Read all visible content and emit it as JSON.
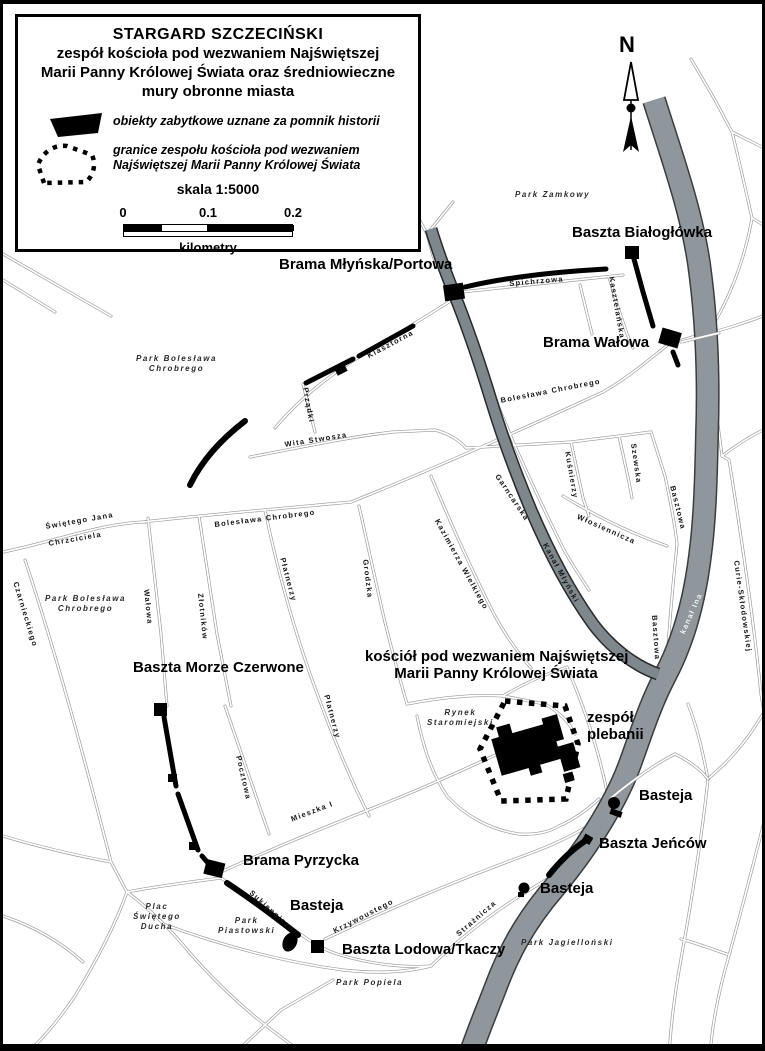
{
  "title_box": {
    "line1": "STARGARD SZCZECIŃSKI",
    "line2": "zespół kościoła pod wezwaniem Najświętszej",
    "line3": "Marii Panny Królowej Świata oraz średniowieczne",
    "line4": "mury obronne miasta",
    "legend_item1": "obiekty zabytkowe uznane za pomnik historii",
    "legend_item2_line1": "granice zespołu kościoła pod wezwaniem",
    "legend_item2_line2": "Najświętszej Marii Panny Królowej Świata",
    "scale_label": "skala 1:5000",
    "scale_ticks": [
      "0",
      "0.1",
      "0.2"
    ],
    "scale_unit": "kilometry"
  },
  "compass": {
    "label": "N"
  },
  "water": {
    "river_label": "kanał Ina",
    "canal_label": "Kanał Młyński",
    "river_color": "#8f979c",
    "canal_color": "#7e878c"
  },
  "monument_labels": [
    {
      "id": "baszta-bialoglowka",
      "lines": [
        "Baszta Białogłówka"
      ],
      "x": 569,
      "y": 220
    },
    {
      "id": "brama-mlynska-portowa",
      "lines": [
        "Brama Młyńska/Portowa"
      ],
      "x": 276,
      "y": 252
    },
    {
      "id": "brama-walowa",
      "lines": [
        "Brama Wałowa"
      ],
      "x": 540,
      "y": 330
    },
    {
      "id": "baszta-morze-czerwone",
      "lines": [
        "Baszta Morze Czerwone"
      ],
      "x": 130,
      "y": 655
    },
    {
      "id": "kosciol-mariacki",
      "lines": [
        "kościół pod wezwaniem Najświętszej",
        "Marii Panny Królowej Świata"
      ],
      "x": 362,
      "y": 644,
      "w": 262,
      "align": "center"
    },
    {
      "id": "zespol-plebanii",
      "lines": [
        "zespół",
        "plebanii"
      ],
      "x": 584,
      "y": 705
    },
    {
      "id": "basteja-polnocna",
      "lines": [
        "Basteja"
      ],
      "x": 636,
      "y": 783
    },
    {
      "id": "baszta-jencow",
      "lines": [
        "Baszta Jeńców"
      ],
      "x": 596,
      "y": 831
    },
    {
      "id": "basteja-wschodnia",
      "lines": [
        "Basteja"
      ],
      "x": 537,
      "y": 876
    },
    {
      "id": "brama-pyrzycka",
      "lines": [
        "Brama Pyrzycka"
      ],
      "x": 240,
      "y": 848
    },
    {
      "id": "basteja-poludniowa",
      "lines": [
        "Basteja"
      ],
      "x": 287,
      "y": 893
    },
    {
      "id": "baszta-lodowa-tkaczy",
      "lines": [
        "Baszta Lodowa/Tkaczy"
      ],
      "x": 339,
      "y": 937
    }
  ],
  "park_labels": [
    {
      "id": "park-zamkowy",
      "lines": [
        "Park Zamkowy"
      ],
      "x": 512,
      "y": 186
    },
    {
      "id": "park-boleslawa-chrobrego-1",
      "lines": [
        "Park Bolesława",
        "Chrobrego"
      ],
      "x": 133,
      "y": 350
    },
    {
      "id": "park-boleslawa-chrobrego-2",
      "lines": [
        "Park Bolesława",
        "Chrobrego"
      ],
      "x": 42,
      "y": 590
    },
    {
      "id": "rynek-staromiejski",
      "lines": [
        "Rynek",
        "Staromiejski"
      ],
      "x": 424,
      "y": 704
    },
    {
      "id": "plac-swietego-ducha",
      "lines": [
        "Plac",
        "Świętego",
        "Ducha"
      ],
      "x": 130,
      "y": 898
    },
    {
      "id": "park-piastowski",
      "lines": [
        "Park",
        "Piastowski"
      ],
      "x": 215,
      "y": 912
    },
    {
      "id": "park-popiela",
      "lines": [
        "Park Popiela"
      ],
      "x": 333,
      "y": 974
    },
    {
      "id": "park-jagiellonski",
      "lines": [
        "Park Jagielloński"
      ],
      "x": 518,
      "y": 934
    }
  ],
  "street_labels": [
    {
      "id": "spichrzowa",
      "text": "Spichrzowa",
      "x": 506,
      "y": 276,
      "rot": -5
    },
    {
      "id": "kasztelanska",
      "text": "Kasztelańska",
      "x": 612,
      "y": 272,
      "rot": 80
    },
    {
      "id": "klasztorna",
      "text": "Klasztorna",
      "x": 363,
      "y": 349,
      "rot": -28
    },
    {
      "id": "przadki",
      "text": "Prządki",
      "x": 306,
      "y": 383,
      "rot": 80
    },
    {
      "id": "wita-stwosza",
      "text": "Wita Stwosza",
      "x": 281,
      "y": 437,
      "rot": -9
    },
    {
      "id": "boleslawa-chrobrego-n",
      "text": "Bolesława Chrobrego",
      "x": 497,
      "y": 393,
      "rot": -11
    },
    {
      "id": "boleslawa-chrobrego-s",
      "text": "Bolesława Chrobrego",
      "x": 211,
      "y": 517,
      "rot": -7
    },
    {
      "id": "swietego-jana",
      "text": "Świętego Jana",
      "x": 42,
      "y": 519,
      "rot": -10
    },
    {
      "id": "chrzciciela",
      "text": "Chrzciciela",
      "x": 45,
      "y": 536,
      "rot": -10
    },
    {
      "id": "czarnieckiego",
      "text": "Czarnieckiego",
      "x": 16,
      "y": 577,
      "rot": 73
    },
    {
      "id": "walowa",
      "text": "Wałowa",
      "x": 147,
      "y": 585,
      "rot": 84
    },
    {
      "id": "zlotnikow",
      "text": "Złotników",
      "x": 201,
      "y": 589,
      "rot": 84
    },
    {
      "id": "platnerzy-n",
      "text": "Płatnerzy",
      "x": 283,
      "y": 553,
      "rot": 75
    },
    {
      "id": "platnerzy-s",
      "text": "Płatnerzy",
      "x": 327,
      "y": 690,
      "rot": 75
    },
    {
      "id": "grodzka",
      "text": "Grodzka",
      "x": 366,
      "y": 555,
      "rot": 83
    },
    {
      "id": "kazimierza-wielkiego",
      "text": "Kazimierza Wielkiego",
      "x": 437,
      "y": 514,
      "rot": 61
    },
    {
      "id": "garncarska",
      "text": "Garncarska",
      "x": 497,
      "y": 469,
      "rot": 56
    },
    {
      "id": "kusnierzy",
      "text": "Kuśnierzy",
      "x": 568,
      "y": 447,
      "rot": 80
    },
    {
      "id": "szewska",
      "text": "Szewska",
      "x": 634,
      "y": 439,
      "rot": 82
    },
    {
      "id": "basztowa-n",
      "text": "Basztowa",
      "x": 673,
      "y": 481,
      "rot": 76
    },
    {
      "id": "basztowa-s",
      "text": "Basztowa",
      "x": 655,
      "y": 611,
      "rot": 86
    },
    {
      "id": "wlosiennicza",
      "text": "Włosiennicza",
      "x": 576,
      "y": 509,
      "rot": 24
    },
    {
      "id": "curie-sklodowskiej",
      "text": "Curie-Skłodowskiej",
      "x": 737,
      "y": 556,
      "rot": 82
    },
    {
      "id": "pocztowa",
      "text": "Pocztowa",
      "x": 239,
      "y": 751,
      "rot": 77
    },
    {
      "id": "mieszka-i",
      "text": "Mieszka I",
      "x": 287,
      "y": 812,
      "rot": -21
    },
    {
      "id": "sukiennicza",
      "text": "Sukiennicza",
      "x": 250,
      "y": 885,
      "rot": 42
    },
    {
      "id": "krzywoustego",
      "text": "Krzywoustego",
      "x": 329,
      "y": 924,
      "rot": -27
    },
    {
      "id": "straznicza",
      "text": "Strażnicza",
      "x": 452,
      "y": 928,
      "rot": -41
    },
    {
      "id": "kanal-ina-label",
      "text": "kanał Ina",
      "x": 676,
      "y": 628,
      "rot": -66,
      "cls": "water-label"
    },
    {
      "id": "kanal-mlynski-label",
      "text": "Kanał Młyński",
      "x": 545,
      "y": 538,
      "rot": 61,
      "cls": "water-label-dark"
    }
  ]
}
